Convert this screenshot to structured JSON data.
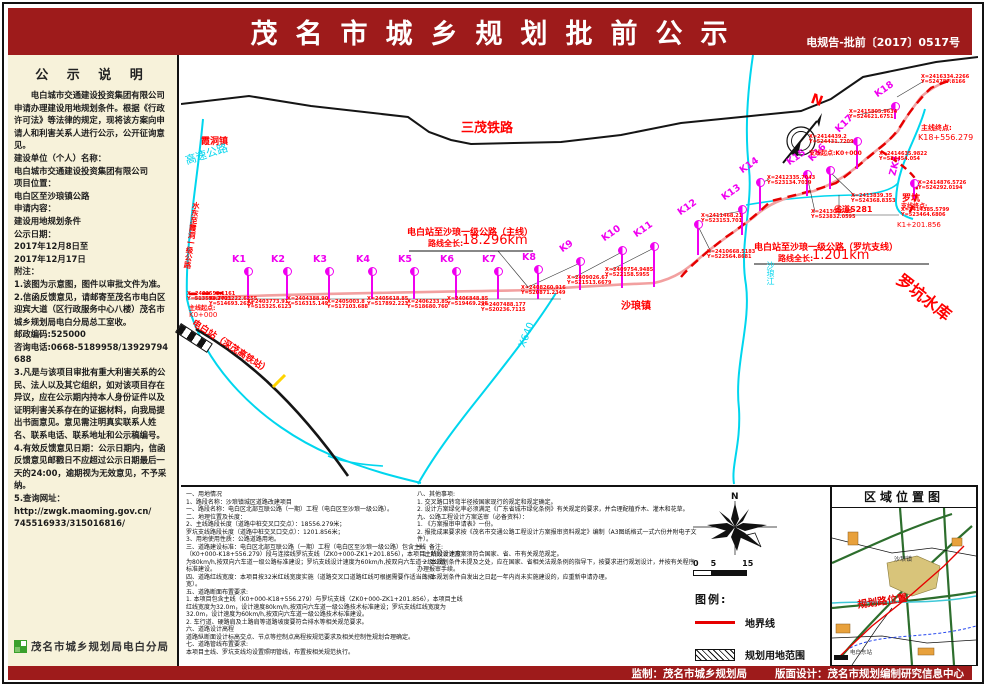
{
  "header": {
    "title": "茂名市城乡规划批前公示",
    "doc_number": "电规告-批前〔2017〕0517号"
  },
  "sidebar": {
    "title": "公 示 说 明",
    "paragraphs": [
      "　　电白城市交通建设投资集团有限公司申请办理建设用地规划条件。根据《行政许可法》等法律的规定，现将该方案向申请人和利害关系人进行公示，公开征询意见。",
      "建设单位（个人）名称：",
      "电白城市交通建设投资集团有限公司",
      "项目位置：",
      "电白区至沙琅镇公路",
      "申请内容：",
      "建设用地规划条件",
      "公示日期：",
      "2017年12月8日至",
      "2017年12月17日",
      "附注：",
      "1.该图为示意图，图件以审批文件为准。",
      "2.信函反馈意见，请邮寄至茂名市电白区迎宾大道（区行政服务中心八楼）茂名市城乡规划局电白分局总工室收。",
      "邮政编码:525000",
      "咨询电话:0668-5189958/13929794688",
      "3.凡是与该项目审批有重大利害关系的公民、法人以及其它组织，如对该项目存在异议，应在公示期内持本人身份证件以及证明利害关系存在的证据材料，向我局提出书面意见。意见需注明真实联系人姓名、联系电话、联系地址和公示稿编号。",
      "4.有效反馈意见日期：公示日期内，信函反馈意见邮戳日不应超过公示日期最后一天的24:00，逾期视为无效意见，不予采纳。",
      "5.查询网址：",
      "http://zwgk.maoming.gov.cn/",
      "745516933/315016816/"
    ],
    "agency": "茂名市城乡规划局电白分局"
  },
  "map": {
    "markers": [
      {
        "id": "K1",
        "x": 67,
        "y": 216,
        "stem": 24,
        "rot": 0
      },
      {
        "id": "K2",
        "x": 106,
        "y": 216,
        "stem": 24,
        "rot": 0
      },
      {
        "id": "K3",
        "x": 148,
        "y": 216,
        "stem": 24,
        "rot": 0
      },
      {
        "id": "K4",
        "x": 191,
        "y": 216,
        "stem": 24,
        "rot": 0
      },
      {
        "id": "K5",
        "x": 233,
        "y": 216,
        "stem": 24,
        "rot": 0
      },
      {
        "id": "K6",
        "x": 275,
        "y": 216,
        "stem": 24,
        "rot": 0
      },
      {
        "id": "K7",
        "x": 317,
        "y": 216,
        "stem": 24,
        "rot": 0
      },
      {
        "id": "K8",
        "x": 357,
        "y": 214,
        "stem": 26,
        "rot": 0
      },
      {
        "id": "K9",
        "x": 399,
        "y": 206,
        "stem": 25,
        "rot": -35
      },
      {
        "id": "K10",
        "x": 441,
        "y": 195,
        "stem": 34,
        "rot": -35
      },
      {
        "id": "K11",
        "x": 473,
        "y": 191,
        "stem": 37,
        "rot": -35
      },
      {
        "id": "K12",
        "x": 517,
        "y": 169,
        "stem": 27,
        "rot": -35
      },
      {
        "id": "K13",
        "x": 561,
        "y": 154,
        "stem": 22,
        "rot": -35
      },
      {
        "id": "K14",
        "x": 579,
        "y": 127,
        "stem": 25,
        "rot": -35
      },
      {
        "id": "K15",
        "x": 626,
        "y": 119,
        "stem": 18,
        "rot": -35
      },
      {
        "id": "K16",
        "x": 649,
        "y": 115,
        "stem": 15,
        "rot": -45
      },
      {
        "id": "K17",
        "x": 676,
        "y": 86,
        "stem": 24,
        "rot": -45
      },
      {
        "id": "K18",
        "x": 714,
        "y": 51,
        "stem": 9,
        "rot": -35
      },
      {
        "id": "ZK1",
        "x": 733,
        "y": 128,
        "stem": 12,
        "rot": -75
      }
    ],
    "coords": [
      {
        "x": 6,
        "y": 237,
        "lines": [
          "X=2402558.1161",
          "Y=513598.7721"
        ]
      },
      {
        "x": 28,
        "y": 242,
        "lines": [
          "X=2403222.6255",
          "Y=514693.2624"
        ]
      },
      {
        "x": 66,
        "y": 245,
        "lines": [
          "X=2403773.91",
          "Y=515325.6123"
        ]
      },
      {
        "x": 106,
        "y": 242,
        "lines": [
          "X=2404388.90",
          "Y=516315.149"
        ]
      },
      {
        "x": 146,
        "y": 245,
        "lines": [
          "X=2405003.8",
          "Y=517103.688"
        ]
      },
      {
        "x": 186,
        "y": 242,
        "lines": [
          "X=2405618.85",
          "Y=517892.223"
        ]
      },
      {
        "x": 226,
        "y": 245,
        "lines": [
          "X=2406233.85",
          "Y=518680.760"
        ]
      },
      {
        "x": 266,
        "y": 242,
        "lines": [
          "X=2406848.85",
          "Y=519469.298"
        ]
      },
      {
        "x": 300,
        "y": 248,
        "lines": [
          "X=2407488.177",
          "Y=520236.7115"
        ]
      },
      {
        "x": 340,
        "y": 231,
        "lines": [
          "X=2408260.916",
          "Y=520871.2349"
        ]
      },
      {
        "x": 386,
        "y": 221,
        "lines": [
          "X=2409026.67",
          "Y=521513.6679"
        ]
      },
      {
        "x": 424,
        "y": 213,
        "lines": [
          "X=2409754.9485",
          "Y=522158.5955"
        ]
      },
      {
        "x": 526,
        "y": 195,
        "lines": [
          "X=2410668.5183",
          "Y=522564.8681"
        ]
      },
      {
        "x": 520,
        "y": 159,
        "lines": [
          "X=2411468.21",
          "Y=523153.701"
        ]
      },
      {
        "x": 586,
        "y": 121,
        "lines": [
          "X=2412335.7043",
          "Y=523134.7039"
        ]
      },
      {
        "x": 630,
        "y": 155,
        "lines": [
          "X=2413046.35",
          "Y=523832.0595"
        ]
      },
      {
        "x": 670,
        "y": 139,
        "lines": [
          "X=2413839.35",
          "Y=524368.8353"
        ]
      },
      {
        "x": 628,
        "y": 80,
        "lines": [
          "X=2414439.2",
          "Y=524431.7209"
        ]
      },
      {
        "x": 698,
        "y": 97,
        "lines": [
          "X=2414635.9822",
          "Y=524454.054"
        ]
      },
      {
        "x": 668,
        "y": 55,
        "lines": [
          "X=2415805.9634",
          "Y=524621.6751"
        ]
      },
      {
        "x": 740,
        "y": 20,
        "lines": [
          "X=2416334.2266",
          "Y=524787.8166"
        ]
      },
      {
        "x": 737,
        "y": 126,
        "lines": [
          "X=2414876.5726",
          "Y=524292.0194"
        ]
      },
      {
        "x": 720,
        "y": 153,
        "lines": [
          "X=2414385.5799",
          "Y=523464.6806"
        ]
      }
    ],
    "labels": [
      {
        "text": "三茂铁路",
        "x": 280,
        "y": 62,
        "size": 13,
        "color": "#ff0000",
        "rot": 0,
        "bold": true
      },
      {
        "text": "霞洞镇",
        "x": 20,
        "y": 79,
        "size": 9,
        "color": "#ff0000",
        "rot": 0,
        "bold": true
      },
      {
        "text": "高速公路",
        "x": 2,
        "y": 98,
        "size": 11,
        "color": "#00d6ee",
        "rot": -18,
        "bold": false
      },
      {
        "text": "水东至霞洞一级公路",
        "x": 10,
        "y": 146,
        "size": 7.5,
        "color": "#ff0000",
        "rot": 8,
        "bold": true,
        "vert": true
      },
      {
        "text": "电白站至沙琅一级公路（主线）",
        "x": 226,
        "y": 170,
        "size": 9,
        "color": "#ff0000",
        "rot": 0,
        "bold": true
      },
      {
        "text": "路线全长:",
        "x": 247,
        "y": 183,
        "size": 8,
        "color": "#ff0000",
        "rot": 0,
        "bold": true
      },
      {
        "text": "18.296km",
        "x": 281,
        "y": 178,
        "size": 13,
        "color": "#ff0000",
        "rot": 0,
        "bold": false
      },
      {
        "text": "电白站至沙琅一级公路（罗坑支线）",
        "x": 573,
        "y": 185,
        "size": 9,
        "color": "#ff0000",
        "rot": 0,
        "bold": true
      },
      {
        "text": "路线全长:",
        "x": 597,
        "y": 198,
        "size": 8,
        "color": "#ff0000",
        "rot": 0,
        "bold": true
      },
      {
        "text": "1.201km",
        "x": 631,
        "y": 193,
        "size": 13,
        "color": "#ff0000",
        "rot": 0,
        "bold": false
      },
      {
        "text": "沙琅镇",
        "x": 440,
        "y": 242,
        "size": 10,
        "color": "#ff0000",
        "rot": 0,
        "bold": true
      },
      {
        "text": "罗坑",
        "x": 721,
        "y": 136,
        "size": 9,
        "color": "#ff0000",
        "rot": 0,
        "bold": true
      },
      {
        "text": "省道S281",
        "x": 653,
        "y": 149,
        "size": 8,
        "color": "#ff0000",
        "rot": 0,
        "bold": true
      },
      {
        "text": "罗坑水库",
        "x": 726,
        "y": 212,
        "size": 16,
        "color": "#ff0000",
        "rot": 38,
        "bold": true
      },
      {
        "text": "主线终点:",
        "x": 740,
        "y": 68,
        "size": 7,
        "color": "#ff0000",
        "rot": 0,
        "bold": true
      },
      {
        "text": "K18+556.279",
        "x": 737,
        "y": 78,
        "size": 8,
        "color": "#ff0000",
        "rot": 0,
        "bold": false
      },
      {
        "text": "支线起点:K0+000",
        "x": 628,
        "y": 93,
        "size": 6,
        "color": "#ff0000",
        "rot": 0,
        "bold": true
      },
      {
        "text": "支线终点:",
        "x": 720,
        "y": 146,
        "size": 6,
        "color": "#ff0000",
        "rot": 0,
        "bold": true
      },
      {
        "text": "K1+201.856",
        "x": 716,
        "y": 166,
        "size": 7,
        "color": "#ff0000",
        "rot": 0,
        "bold": false
      },
      {
        "text": "主线起点:",
        "x": 8,
        "y": 248,
        "size": 6,
        "color": "#ff0000",
        "rot": 0,
        "bold": true
      },
      {
        "text": "K0+000",
        "x": 8,
        "y": 256,
        "size": 7,
        "color": "#ff0000",
        "rot": 0,
        "bold": false
      },
      {
        "text": "电白站（深茂高铁站）",
        "x": 16,
        "y": 261,
        "size": 9,
        "color": "#ff0000",
        "rot": 33,
        "bold": true
      },
      {
        "text": "X640",
        "x": 336,
        "y": 290,
        "size": 10,
        "color": "#00d6ee",
        "rot": -68,
        "bold": false
      },
      {
        "text": "N",
        "x": 633,
        "y": 36,
        "size": 14,
        "color": "#ff0000",
        "rot": 20,
        "bold": true
      },
      {
        "text": "沙琅江",
        "x": 584,
        "y": 206,
        "size": 8,
        "color": "#00d6ee",
        "rot": 0,
        "bold": false,
        "vert": true
      }
    ]
  },
  "notes": {
    "left": [
      "一、用地情况",
      "1、路段名称：沙琅镇城区道路改建项目",
      "一、路段名称：电白区北部互联公路（一期）工程（电白区至沙琅一级公路）。",
      "二、地理位置及长度：",
      "2、主线路段长度（道路中桩交叉口交点）：18556.279米；",
      "罗坑支线路段长度（道路中桩交叉口交点）：1201.856米；",
      "3、用地使用性质：公路道路用地。",
      "三、道路建设标准：电白区北部互联公路（一期）工程（电白区至沙琅一级公路）包含主线",
      "（K0+000-K18+556.279）段与连接线罗坑支线（ZK0+000-ZK1+201.856），本项目主线设计速度",
      "为80km/h,按双向六车道一级公路标准建设；罗坑支线设计速度为60km/h,按双向六车道一级公路",
      "标准建设。",
      "四、道路红线宽度：本项目按32米红线宽度实施（道路交叉口道路红线可根据需要作适当的拓",
      "宽）。",
      "五、道路断面布置要求:",
      "1. 本项目包含主线（K0+000-K18+556.279）与罗坑支线（ZK0+000-ZK1+201.856），本项目主线",
      "红线宽度为32.0m，设计速度80km/h,按双向六车道一级公路技术标准建设；罗坑支线红线宽度为",
      "32.0m，设计速度为60km/h,按双向六车道一级公路技术标准建设。",
      "2. 车行道、硬路肩及土路肩等道路坡度要符合排水等相关规范要求。",
      "六、道路设计高程",
      "道路纵断面设计标高交点、节点等控制点高程按规范要求及相关控制性规划合理确定。",
      "七、道路管线布置要求:",
      "本项目主线、罗坑支线均设置照明管线，布置按相关规范执行。"
    ],
    "right": [
      "八、其他事项:",
      "1. 交叉路口转弯半径按国家现行的规定和规定确定。",
      "2. 设计方案绿化率必须满足《广东省城市绿化条例》有关规定的要求，并合理配植乔木、灌木和花草。",
      "九、公路工程设计方案送审（必备资料）：",
      "1. 《方案报审申请表》一份。",
      "2. 报批成果要求按《茂名市交通公路工程设计方案报审资料规定》编制（A3图纸格式一式六份并附电子文",
      "件）。",
      "十、备注:",
      "　1. 阶段设计方案须符合国家、省、市有关规范规定。",
      "　2. 本规划条件未提及之处，应在国家、省相关法规条例的指导下，按要求进行规划设计，并按有关程序",
      "办理报审手续。",
      "　3. 本规划条件自发出之日起一年内尚未实施建设的，应重新申请办理。"
    ]
  },
  "legend": {
    "scale_ticks": [
      "0",
      "5",
      "15"
    ],
    "title": "图例:",
    "items": [
      {
        "label": "地界线",
        "swatch": "line"
      },
      {
        "label": "规划用地范围",
        "swatch": "hatch"
      }
    ]
  },
  "region_map": {
    "title": "区域位置图",
    "road_label": "规划路位置",
    "town_label": "沙琅镇",
    "station_label": "电白东站"
  },
  "footer": {
    "producer": "监制：茂名市城乡规划局",
    "designer": "版面设计：茂名市规划编制研究信息中心"
  },
  "colors": {
    "banner": "#9e1b1b",
    "magenta": "#f000f0",
    "cyan": "#00d6ee",
    "red": "#ff0000",
    "road_pink": "#f2a0a0",
    "sidebar_bg": "#f7f2da"
  }
}
